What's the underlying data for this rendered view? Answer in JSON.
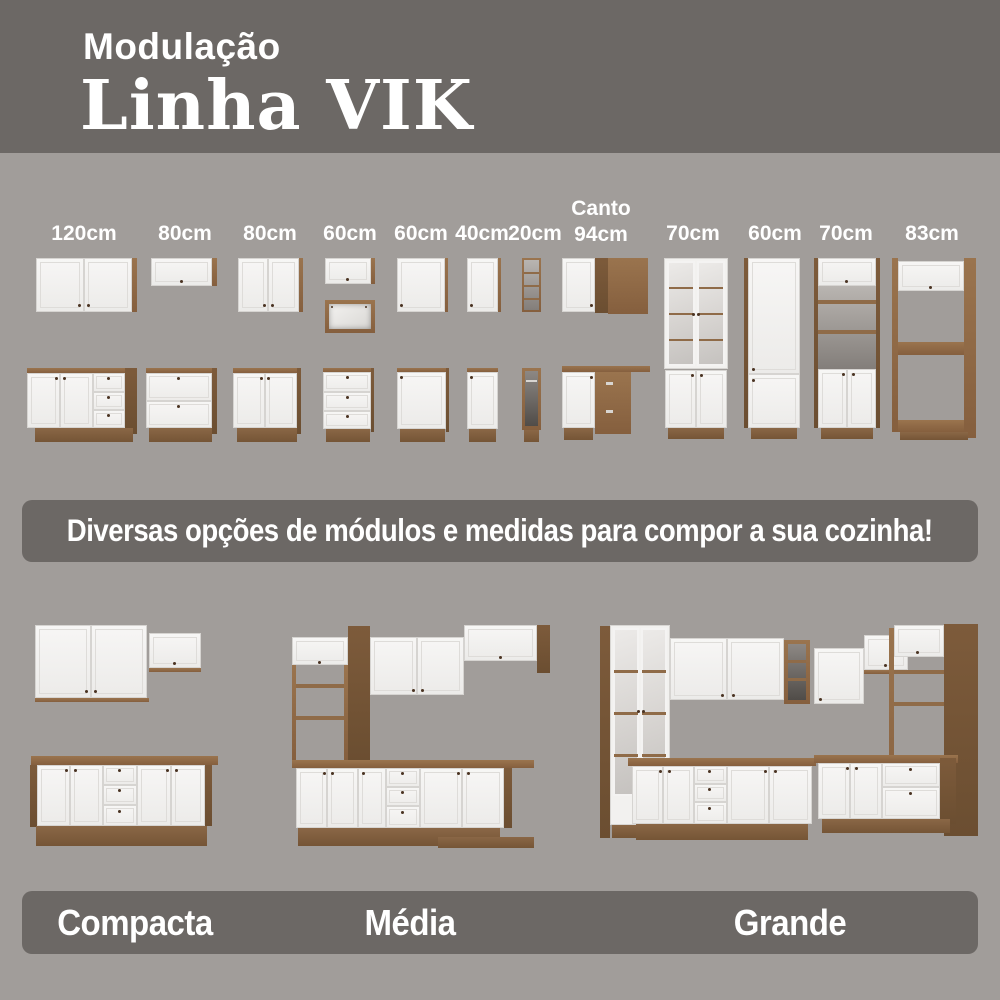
{
  "header": {
    "kicker": "Modulação",
    "title": "Linha VIK"
  },
  "measurements": [
    {
      "label": "120cm"
    },
    {
      "label": "80cm"
    },
    {
      "label": "80cm"
    },
    {
      "label": "60cm"
    },
    {
      "label": "60cm"
    },
    {
      "label": "40cm"
    },
    {
      "label": "20cm"
    },
    {
      "prefix": "Canto",
      "label": "94cm"
    },
    {
      "label": "70cm"
    },
    {
      "label": "60cm"
    },
    {
      "label": "70cm"
    },
    {
      "label": "83cm"
    }
  ],
  "banner": {
    "text": "Diversas opções de módulos e medidas para compor a sua cozinha!"
  },
  "kitchen_sizes": [
    {
      "label": "Compacta"
    },
    {
      "label": "Média"
    },
    {
      "label": "Grande"
    }
  ],
  "colors": {
    "background": "#a19d9a",
    "band": "#6c6865",
    "text": "#ffffff",
    "door_white": "#f4f3f1",
    "wood": "#9a744e",
    "wood_dark": "#7d5b3b"
  }
}
